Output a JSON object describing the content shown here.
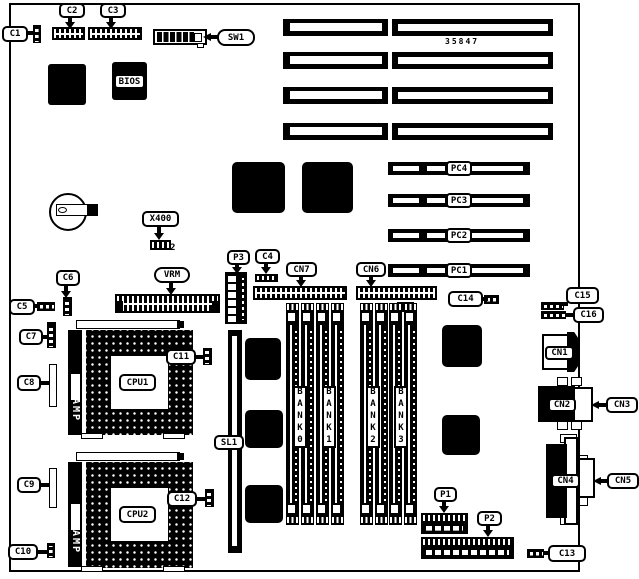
{
  "diagram": {
    "part_number": "35847",
    "callouts": {
      "c1": "C1",
      "c2": "C2",
      "c3": "C3",
      "c4": "C4",
      "c5": "C5",
      "c6": "C6",
      "c7": "C7",
      "c8": "C8",
      "c9": "C9",
      "c10": "C10",
      "c11": "C11",
      "c12": "C12",
      "c13": "C13",
      "c14": "C14",
      "c15": "C15",
      "c16": "C16",
      "sw1": "SW1",
      "x400": "X400",
      "x400_pin2": "2",
      "vrm": "VRM",
      "p1": "P1",
      "p2": "P2",
      "p3": "P3",
      "cn1": "CN1",
      "cn2": "CN2",
      "cn3": "CN3",
      "cn4": "CN4",
      "cn5": "CN5",
      "cn6": "CN6",
      "cn7": "CN7",
      "sl1": "SL1",
      "bios": "BIOS",
      "cpu1": "CPU1",
      "cpu2": "CPU2",
      "amp": "AMP"
    },
    "pci_slots": [
      "PC4",
      "PC3",
      "PC2",
      "PC1"
    ],
    "memory_banks": [
      "BANK0",
      "BANK1",
      "BANK2",
      "BANK3"
    ]
  }
}
